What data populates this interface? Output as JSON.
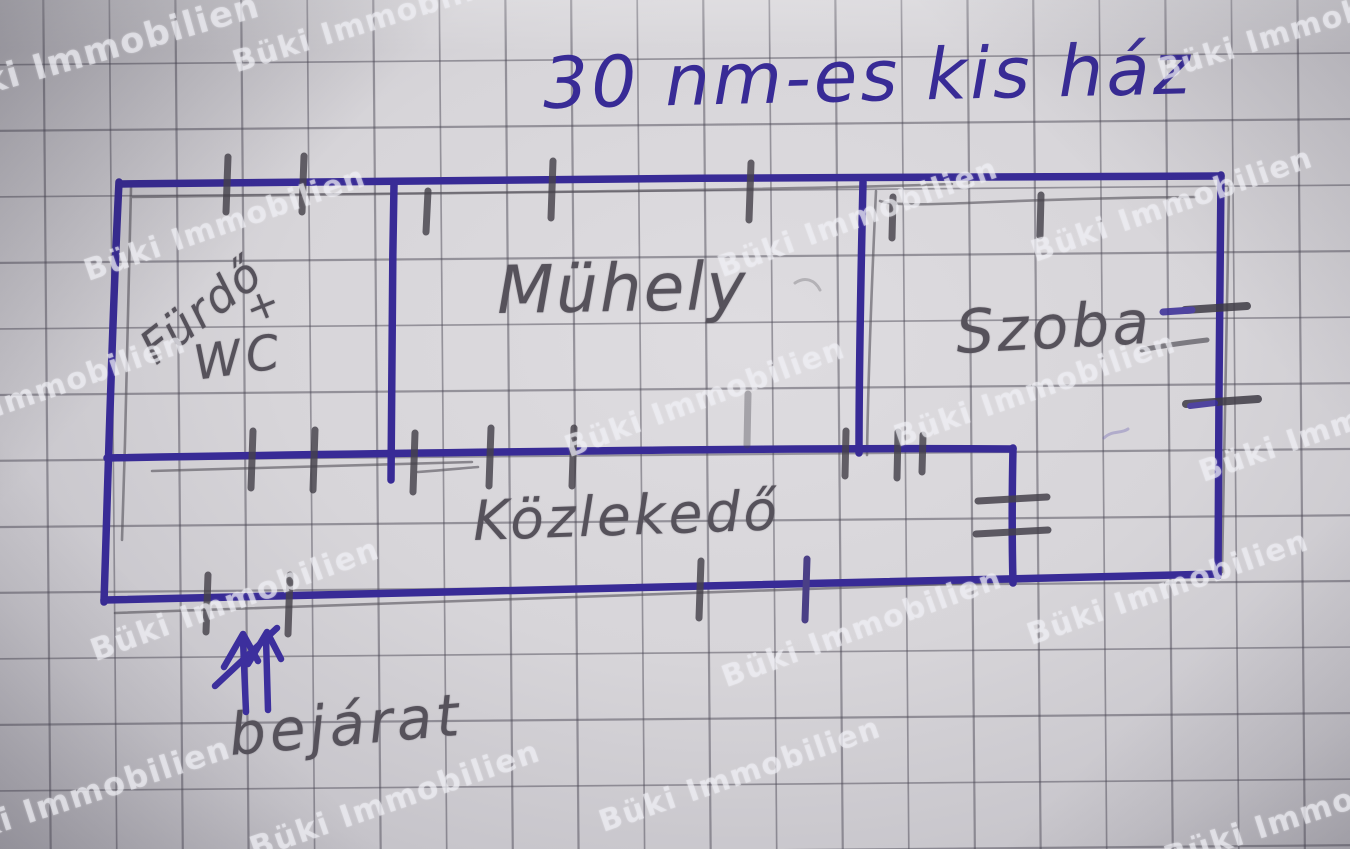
{
  "meta": {
    "kind": "hand-drawn floor plan photo",
    "language": "Hungarian"
  },
  "title": "30 nm-es kis ház",
  "watermark": "Büki Immobilien",
  "rooms": [
    {
      "id": "furdo-wc",
      "label_line1": "Fürdő",
      "label_plus": "+",
      "label_line2": "WC"
    },
    {
      "id": "muhely",
      "label": "Mühely"
    },
    {
      "id": "szoba",
      "label": "Szoba"
    },
    {
      "id": "kozlekedo",
      "label": "Közlekedő"
    }
  ],
  "entrance": {
    "label": "bejárat",
    "symbol": "double-arrow-up"
  },
  "colors": {
    "ink": "#382b96",
    "pencil": "#56525b",
    "paper": "#d7d5d9",
    "grid_line": "#484552",
    "watermark": "#eeedf3"
  }
}
